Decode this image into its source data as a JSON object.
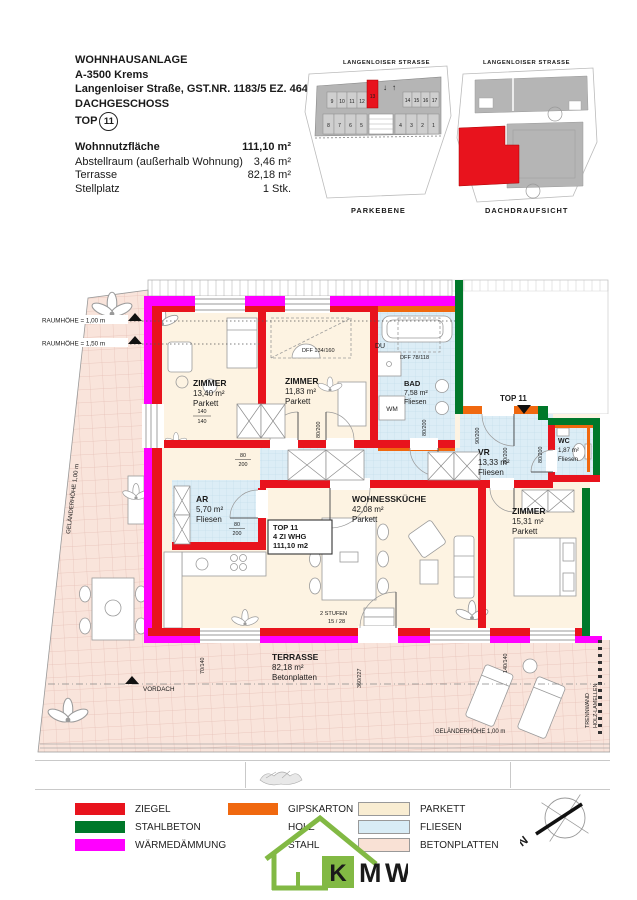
{
  "header": {
    "project": "WOHNHAUSANLAGE",
    "city": "A-3500 Krems",
    "street": "Langenloiser Straße, GST.NR. 1183/5 EZ. 4648",
    "level": "DACHGESCHOSS",
    "top_label": "TOP",
    "top_number": "11"
  },
  "area_table": {
    "rows": [
      {
        "label": "Wohnnutzfläche",
        "value": "111,10 m²"
      },
      {
        "label": "Abstellraum (außerhalb Wohnung)",
        "value": "3,46 m²"
      },
      {
        "label": "Terrasse",
        "value": "82,18 m²"
      },
      {
        "label": "Stellplatz",
        "value": "1 Stk."
      }
    ]
  },
  "mini": {
    "street": "LANGENLOISER STRASSE",
    "parkebene": {
      "caption": "PARKEBENE",
      "spots_top": [
        "9",
        "10",
        "11",
        "12",
        "13",
        "14",
        "15",
        "16",
        "17"
      ],
      "spots_bottom": [
        "8",
        "7",
        "6",
        "5",
        "4",
        "3",
        "2",
        "1"
      ],
      "arrow_down": "↓",
      "arrow_up": "↑",
      "highlight_spot": "13"
    },
    "dach": {
      "caption": "DACHDRAUFSICHT"
    }
  },
  "plan": {
    "rooms": {
      "zimmer1": {
        "name": "ZIMMER",
        "area": "13,40 m²",
        "floor": "Parkett"
      },
      "zimmer2": {
        "name": "ZIMMER",
        "area": "11,83 m²",
        "floor": "Parkett"
      },
      "bad": {
        "name": "BAD",
        "area": "7,58 m²",
        "floor": "Fliesen"
      },
      "du": {
        "name": "DU"
      },
      "wm": {
        "name": "WM"
      },
      "vr": {
        "name": "VR",
        "area": "13,33 m²",
        "floor": "Fliesen"
      },
      "wc": {
        "name": "WC",
        "area": "1,87 m²",
        "floor": "Fliesen"
      },
      "ar": {
        "name": "AR",
        "area": "5,70 m²",
        "floor": "Fliesen"
      },
      "kueche": {
        "name": "WOHNESSKÜCHE",
        "area": "42,08 m²",
        "floor": "Parkett"
      },
      "zimmer3": {
        "name": "ZIMMER",
        "area": "15,31 m²",
        "floor": "Parkett"
      },
      "terrasse": {
        "name": "TERRASSE",
        "area": "82,18 m²",
        "floor": "Betonplatten"
      }
    },
    "unit_box": {
      "line1": "TOP 11",
      "line2": "4 ZI WHG",
      "line3": "111,10 m2"
    },
    "entry_label": "TOP 11",
    "ann": {
      "raumhoehe1": "RAUMHÖHE = 1,00 m",
      "raumhoehe2": "RAUMHÖHE = 1,50 m",
      "dff_134": "DFF 134/160",
      "dff_78": "DFF 78/118",
      "vordach": "VORDACH",
      "gelaender": "GELÄNDERHÖHE 1,00 m",
      "trennwand1": "TRENNWAND",
      "trennwand2": "HOLZ-LAMELLEN",
      "stufen1": "2 STUFEN",
      "stufen2": "15 / 28"
    },
    "dims": {
      "d80": "80",
      "d200": "200",
      "d140": "140",
      "d80_200": "80/200",
      "d90_200": "90/200",
      "d70_140": "70/140",
      "d360_227": "360/227",
      "d140_140": "140/140"
    },
    "colors": {
      "ziegel": "#e8131d",
      "stahlbeton": "#00782a",
      "waermedaemmung": "#ff00ff",
      "gipskarton": "#f0680f",
      "parkett": "#fdf3e2",
      "fliesen": "#dcedf6",
      "betonplatten": "#f9e4db"
    }
  },
  "legend": {
    "items": [
      {
        "label": "ZIEGEL",
        "color": "#e8131d"
      },
      {
        "label": "STAHLBETON",
        "color": "#00782a"
      },
      {
        "label": "WÄRMEDÄMMUNG",
        "color": "#ff00ff"
      },
      {
        "label": "GIPSKARTON",
        "color": "#f0680f"
      },
      {
        "label": "HOLZ"
      },
      {
        "label": "STAHL"
      },
      {
        "label": "PARKETT",
        "color": "#f9edd2"
      },
      {
        "label": "FLIESEN",
        "color": "#d8ecf6"
      },
      {
        "label": "BETONPLATTEN",
        "color": "#f9e1d5"
      }
    ]
  },
  "logo": {
    "k": "K",
    "m": "M",
    "w": "W"
  },
  "compass": {
    "label": "N"
  }
}
